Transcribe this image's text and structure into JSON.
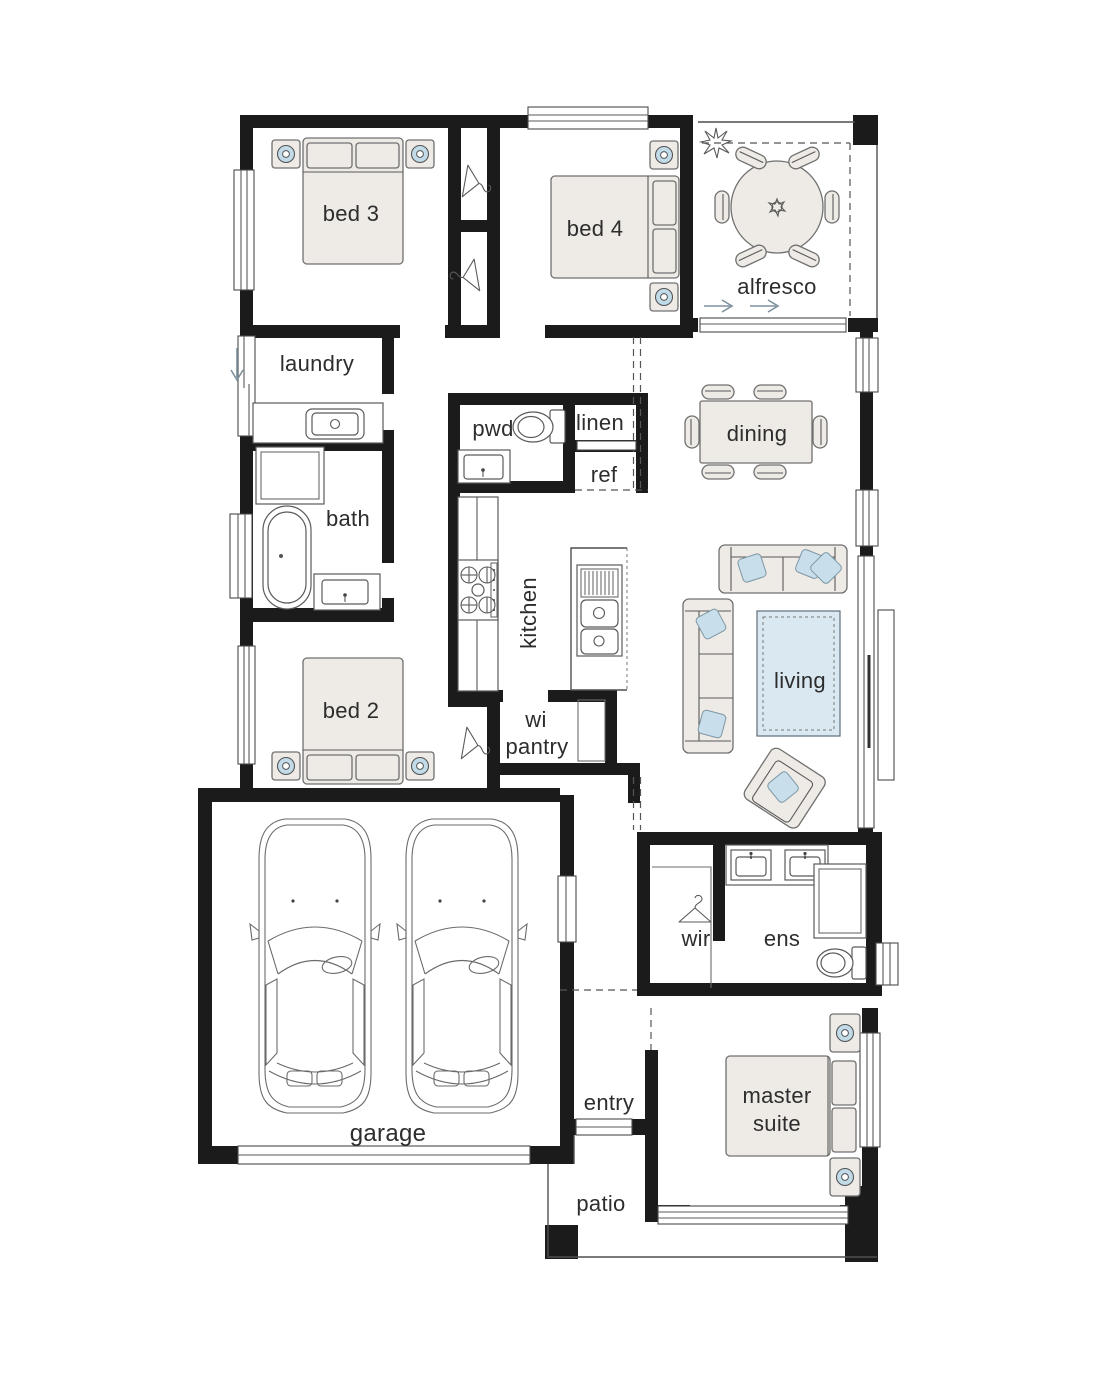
{
  "plan": {
    "rooms": {
      "bed3": {
        "label": "bed 3"
      },
      "bed4": {
        "label": "bed 4"
      },
      "alfresco": {
        "label": "alfresco"
      },
      "laundry": {
        "label": "laundry"
      },
      "pwd": {
        "label": "pwd"
      },
      "linen": {
        "label": "linen"
      },
      "ref": {
        "label": "ref"
      },
      "dining": {
        "label": "dining"
      },
      "bath": {
        "label": "bath"
      },
      "kitchen": {
        "label": "kitchen"
      },
      "living": {
        "label": "living"
      },
      "bed2": {
        "label": "bed 2"
      },
      "wi_pantry": {
        "lines": [
          "wi",
          "pantry"
        ]
      },
      "wir": {
        "label": "wir"
      },
      "ens": {
        "label": "ens"
      },
      "garage": {
        "label": "garage"
      },
      "entry": {
        "label": "entry"
      },
      "master_suite": {
        "lines": [
          "master",
          "suite"
        ]
      },
      "patio": {
        "label": "patio"
      }
    },
    "colors": {
      "wall": "#1b1b1b",
      "line": "#4f4f4f",
      "furniture_fill": "#eeeae5",
      "pillow": "#c8deea",
      "rug": "#d9e8f1",
      "lamp": "#c2dbe9",
      "label_text": "#2d2d2d"
    }
  }
}
